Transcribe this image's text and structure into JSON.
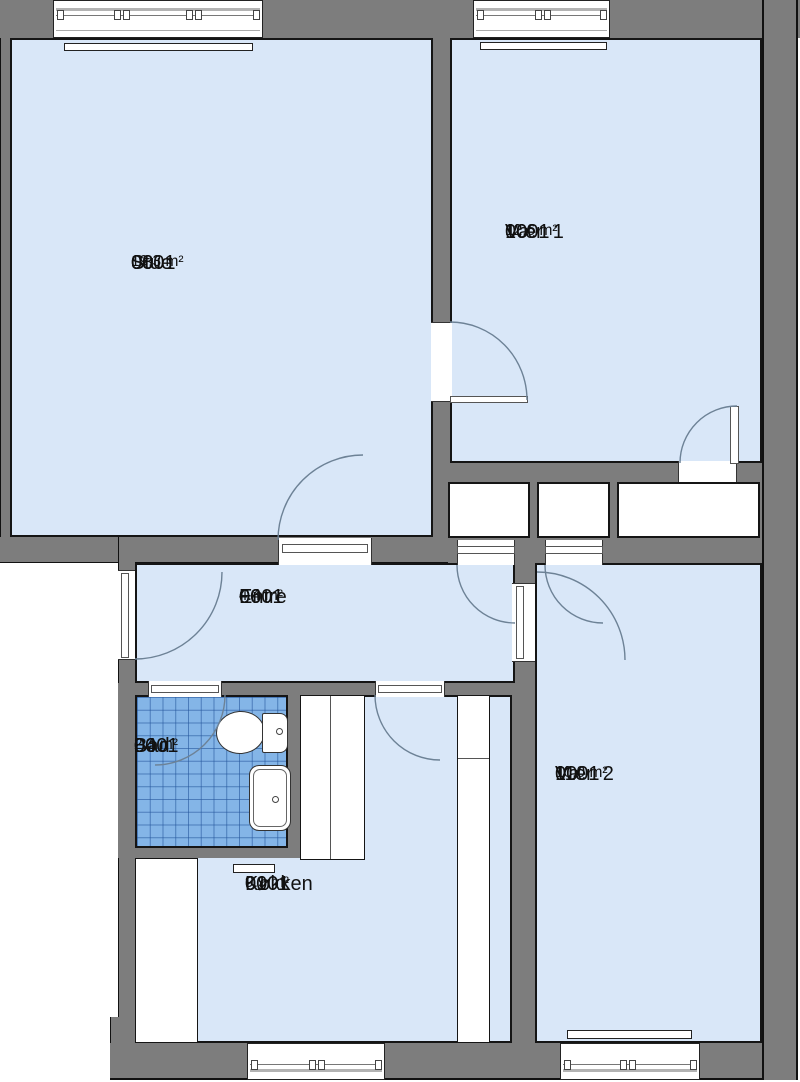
{
  "plan": {
    "rooms": [
      {
        "id": "stue",
        "building": "0001",
        "number": "08",
        "name": "Stue",
        "area": "19.3 m²"
      },
      {
        "id": "vaer-1",
        "building": "0001",
        "number": "10",
        "name": "Vær. 1",
        "area": "12.6 m²"
      },
      {
        "id": "entre",
        "building": "0001",
        "number": "06",
        "name": "Entre",
        "area": "4.4 m²"
      },
      {
        "id": "bad",
        "building": "0001",
        "number": "04",
        "name": "Bad",
        "area": "2.3 m²"
      },
      {
        "id": "koekken",
        "building": "0001",
        "number": "01",
        "name": "Køkken",
        "area": "9.9 m²"
      },
      {
        "id": "vaer-2",
        "building": "0001",
        "number": "11",
        "name": "Vær. 2",
        "area": "10.0 m²"
      }
    ],
    "colors": {
      "wall": "#7d7d7d",
      "room_floor": "#d9e7f8",
      "bath_tile": "#84b5e7",
      "bath_tile_grid": "#4d82c4",
      "outline": "#151515",
      "door_swing": "#6d8296",
      "fixture_fill": "#ffffff"
    }
  }
}
